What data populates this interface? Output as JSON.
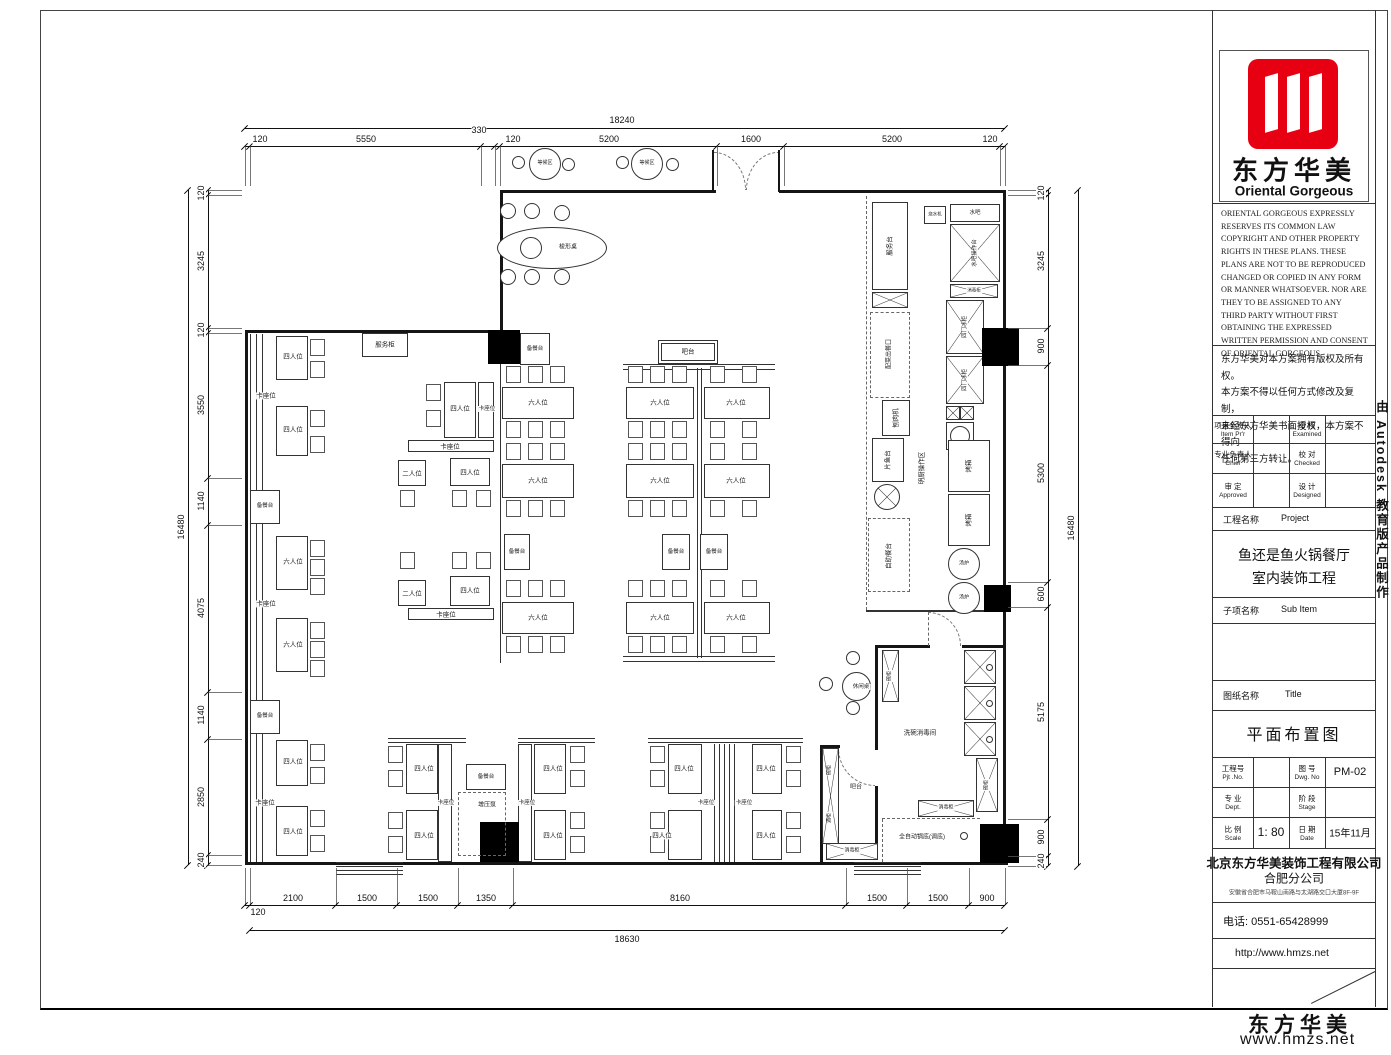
{
  "sheet": {
    "autodesk_strip": "由 Autodesk 教育版产品制作",
    "watermark_cn": "东方华美",
    "watermark_url": "www.hmzs.net"
  },
  "title_block": {
    "logo_cn": "东方华美",
    "logo_en": "Oriental Gorgeous",
    "logo_color": "#e60012",
    "copyright_en": "ORIENTAL GORGEOUS EXPRESSLY RESERVES ITS COMMON LAW COPYRIGHT AND OTHER PROPERTY RIGHTS IN THESE PLANS. THESE PLANS ARE NOT TO BE REPRODUCED CHANGED OR COPIED IN ANY FORM OR MANNER WHATSOEVER. NOR ARE THEY TO BE ASSIGNED TO ANY THIRD PARTY WITHOUT FIRST OBTAINING THE EXPRESSED WRITTEN PERMISSION AND CONSENT OF ORIENTAL GORGEOUS",
    "copyright_cn": "东方华美对本方案拥有版权及所有权。\n本方案不得以任何方式修改及复制，\n未经东方华美书面授权，本方案不得向\n任何第三方转让。",
    "fields": {
      "item_principal_cn": "项目负责人",
      "item_principal_en": "Item Pr'r",
      "examined_cn": "审 核",
      "examined_en": "Examined",
      "chief_cn": "专业负责人",
      "chief_en": "Chief",
      "checked_cn": "校 对",
      "checked_en": "Checked",
      "approved_cn": "审 定",
      "approved_en": "Approved",
      "designed_cn": "设 计",
      "designed_en": "Designed",
      "project_label_cn": "工程名称",
      "project_label_en": "Project",
      "project_name_line1": "鱼还是鱼火锅餐厅",
      "project_name_line2": "室内装饰工程",
      "subitem_label_cn": "子项名称",
      "subitem_label_en": "Sub Item",
      "title_label_cn": "图纸名称",
      "title_label_en": "Title",
      "drawing_title": "平面布置图",
      "pjt_no_cn": "工程号",
      "pjt_no_en": "Pjt .No.",
      "dwg_no_cn": "图 号",
      "dwg_no_en": "Dwg. No",
      "dwg_no_value": "PM-02",
      "dept_cn": "专 业",
      "dept_en": "Dept.",
      "stage_cn": "阶 段",
      "stage_en": "Stage",
      "scale_cn": "比 例",
      "scale_en": "Scale",
      "scale_value": "1: 80",
      "date_cn": "日 期",
      "date_en": "Date",
      "date_value": "15年11月",
      "company_line1": "北京东方华美装饰工程有限公司",
      "company_line2": "合肥分公司",
      "company_address": "安徽省合肥市马鞍山南路与太湖路交口大厦8F-9F",
      "phone": "电话: 0551-65428999",
      "website": "http://www.hmzs.net"
    }
  },
  "plan": {
    "dims": [
      {
        "o": "h",
        "y": 128,
        "a": 245,
        "b": 1005,
        "off": -8,
        "ticks": [
          245,
          1005
        ],
        "labels": [
          {
            "t": "18240",
            "p": 622
          }
        ]
      },
      {
        "o": "h",
        "y": 146,
        "a": 245,
        "b": 1005,
        "off": -7,
        "ext": 40,
        "ticks": [
          245,
          250,
          481,
          495,
          500,
          717,
          784,
          1000,
          1005
        ],
        "labels": [
          {
            "t": "120",
            "p": 260
          },
          {
            "t": "5550",
            "p": 366
          },
          {
            "t": "330",
            "p": 479,
            "dy": -9
          },
          {
            "t": "120",
            "p": 513
          },
          {
            "t": "5200",
            "p": 609
          },
          {
            "t": "1600",
            "p": 751
          },
          {
            "t": "5200",
            "p": 892
          },
          {
            "t": "120",
            "p": 990
          }
        ]
      },
      {
        "o": "h",
        "y": 905,
        "a": 245,
        "b": 1005,
        "off": -7,
        "ext": -37,
        "ticks": [
          245,
          250,
          336,
          397,
          458,
          513,
          846,
          907,
          969,
          1005
        ],
        "labels": [
          {
            "t": "120",
            "p": 258,
            "dy": 14
          },
          {
            "t": "2100",
            "p": 293
          },
          {
            "t": "1500",
            "p": 367
          },
          {
            "t": "1500",
            "p": 428
          },
          {
            "t": "1350",
            "p": 486
          },
          {
            "t": "8160",
            "p": 680
          },
          {
            "t": "1500",
            "p": 877
          },
          {
            "t": "1500",
            "p": 938
          },
          {
            "t": "900",
            "p": 987
          }
        ]
      },
      {
        "o": "h",
        "y": 930,
        "a": 250,
        "b": 1005,
        "off": 9,
        "ticks": [
          250,
          1005
        ],
        "labels": [
          {
            "t": "18630",
            "p": 627
          }
        ]
      },
      {
        "o": "v",
        "x": 208,
        "a": 190,
        "b": 865,
        "off": -7,
        "ext": 34,
        "ticks": [
          190,
          195,
          328,
          333,
          478,
          525,
          692,
          739,
          855,
          865
        ],
        "labels": [
          {
            "t": "120",
            "p": 193
          },
          {
            "t": "3245",
            "p": 261
          },
          {
            "t": "120",
            "p": 330
          },
          {
            "t": "3550",
            "p": 405
          },
          {
            "t": "1140",
            "p": 501
          },
          {
            "t": "4075",
            "p": 608
          },
          {
            "t": "1140",
            "p": 715
          },
          {
            "t": "2850",
            "p": 797
          },
          {
            "t": "240",
            "p": 860
          }
        ]
      },
      {
        "o": "v",
        "x": 188,
        "a": 190,
        "b": 865,
        "off": -7,
        "ticks": [
          190,
          865
        ],
        "labels": [
          {
            "t": "16480",
            "p": 527
          }
        ]
      },
      {
        "o": "v",
        "x": 1048,
        "a": 190,
        "b": 866,
        "off": -7,
        "ext": -40,
        "ticks": [
          190,
          195,
          328,
          365,
          582,
          607,
          819,
          856,
          866
        ],
        "labels": [
          {
            "t": "120",
            "p": 193
          },
          {
            "t": "3245",
            "p": 261
          },
          {
            "t": "900",
            "p": 346
          },
          {
            "t": "5300",
            "p": 473
          },
          {
            "t": "600",
            "p": 594
          },
          {
            "t": "5175",
            "p": 712
          },
          {
            "t": "900",
            "p": 837
          },
          {
            "t": "240",
            "p": 861
          }
        ]
      },
      {
        "o": "v",
        "x": 1078,
        "a": 190,
        "b": 866,
        "off": -7,
        "ticks": [
          190,
          866
        ],
        "labels": [
          {
            "t": "16480",
            "p": 528
          }
        ]
      }
    ],
    "labels": [
      {
        "t": "服务柜",
        "x": 385,
        "y": 345
      },
      {
        "t": "四人位",
        "x": 293,
        "y": 357
      },
      {
        "t": "卡座位",
        "x": 266,
        "y": 396
      },
      {
        "t": "四人位",
        "x": 293,
        "y": 430
      },
      {
        "t": "备餐台",
        "x": 265,
        "y": 506,
        "fs": 5.5
      },
      {
        "t": "六人位",
        "x": 293,
        "y": 562
      },
      {
        "t": "卡座位",
        "x": 266,
        "y": 604
      },
      {
        "t": "六人位",
        "x": 293,
        "y": 645
      },
      {
        "t": "备餐台",
        "x": 265,
        "y": 716,
        "fs": 5.5
      },
      {
        "t": "四人位",
        "x": 293,
        "y": 762
      },
      {
        "t": "卡座位",
        "x": 265,
        "y": 803
      },
      {
        "t": "四人位",
        "x": 293,
        "y": 832
      },
      {
        "t": "四人位",
        "x": 460,
        "y": 409
      },
      {
        "t": "卡座位",
        "x": 487,
        "y": 409,
        "fs": 5.5
      },
      {
        "t": "卡座位",
        "x": 450,
        "y": 447
      },
      {
        "t": "二人位",
        "x": 412,
        "y": 474
      },
      {
        "t": "四人位",
        "x": 470,
        "y": 473
      },
      {
        "t": "二人位",
        "x": 412,
        "y": 594
      },
      {
        "t": "四人位",
        "x": 470,
        "y": 591
      },
      {
        "t": "卡座位",
        "x": 446,
        "y": 615
      },
      {
        "t": "备餐台",
        "x": 535,
        "y": 349,
        "fs": 5.5
      },
      {
        "t": "六人位",
        "x": 538,
        "y": 403
      },
      {
        "t": "六人位",
        "x": 538,
        "y": 481
      },
      {
        "t": "备餐台",
        "x": 517,
        "y": 552,
        "fs": 5.5
      },
      {
        "t": "六人位",
        "x": 538,
        "y": 618
      },
      {
        "t": "吧台",
        "x": 688,
        "y": 352
      },
      {
        "t": "六人位",
        "x": 660,
        "y": 403
      },
      {
        "t": "六人位",
        "x": 736,
        "y": 403
      },
      {
        "t": "六人位",
        "x": 660,
        "y": 481
      },
      {
        "t": "六人位",
        "x": 736,
        "y": 481
      },
      {
        "t": "备餐台",
        "x": 676,
        "y": 552,
        "fs": 5.5
      },
      {
        "t": "备餐台",
        "x": 714,
        "y": 552,
        "fs": 5.5
      },
      {
        "t": "六人位",
        "x": 660,
        "y": 618
      },
      {
        "t": "六人位",
        "x": 736,
        "y": 618
      },
      {
        "t": "服务台",
        "x": 890,
        "y": 246,
        "k": "r"
      },
      {
        "t": "配菜出餐口",
        "x": 890,
        "y": 354,
        "k": "r",
        "fs": 6
      },
      {
        "t": "刨肉机",
        "x": 896,
        "y": 418,
        "k": "r"
      },
      {
        "t": "片鱼台",
        "x": 888,
        "y": 460,
        "k": "r"
      },
      {
        "t": "自助餐台",
        "x": 889,
        "y": 556,
        "k": "r"
      },
      {
        "t": "明厨操作区",
        "x": 922,
        "y": 468,
        "k": "r"
      },
      {
        "t": "烧水机",
        "x": 935,
        "y": 215,
        "fs": 4.5
      },
      {
        "t": "水吧",
        "x": 975,
        "y": 213,
        "fs": 5.5
      },
      {
        "t": "水吧操作台",
        "x": 975,
        "y": 253,
        "k": "r",
        "fs": 5.5
      },
      {
        "t": "消毒柜",
        "x": 974,
        "y": 291,
        "fs": 4.5
      },
      {
        "t": "四门冰柜",
        "x": 965,
        "y": 327,
        "k": "r",
        "fs": 5.5
      },
      {
        "t": "四门冰柜",
        "x": 965,
        "y": 380,
        "k": "r",
        "fs": 5.5
      },
      {
        "t": "烤箱",
        "x": 969,
        "y": 466,
        "k": "r"
      },
      {
        "t": "烤箱",
        "x": 969,
        "y": 520,
        "k": "r"
      },
      {
        "t": "汤炉",
        "x": 964,
        "y": 564,
        "fs": 5
      },
      {
        "t": "汤炉",
        "x": 964,
        "y": 598,
        "fs": 5
      },
      {
        "t": "等候区",
        "x": 545,
        "y": 164,
        "k": "c"
      },
      {
        "t": "等候区",
        "x": 647,
        "y": 164,
        "k": "c"
      },
      {
        "t": "梭形桌",
        "x": 568,
        "y": 248,
        "fs": 6
      },
      {
        "t": "四人位",
        "x": 424,
        "y": 769
      },
      {
        "t": "卡座位",
        "x": 446,
        "y": 803,
        "fs": 5.5
      },
      {
        "t": "四人位",
        "x": 424,
        "y": 836
      },
      {
        "t": "备餐台",
        "x": 486,
        "y": 777,
        "fs": 5.5
      },
      {
        "t": "增压泵",
        "x": 487,
        "y": 806,
        "fs": 6
      },
      {
        "t": "四人位",
        "x": 553,
        "y": 769
      },
      {
        "t": "卡座位",
        "x": 527,
        "y": 803,
        "fs": 5.5
      },
      {
        "t": "四人位",
        "x": 553,
        "y": 836
      },
      {
        "t": "四人位",
        "x": 684,
        "y": 769
      },
      {
        "t": "卡座位",
        "x": 706,
        "y": 803,
        "fs": 5.5
      },
      {
        "t": "卡座位",
        "x": 744,
        "y": 803,
        "fs": 5.5
      },
      {
        "t": "四人位",
        "x": 766,
        "y": 769
      },
      {
        "t": "四人位",
        "x": 662,
        "y": 836
      },
      {
        "t": "四人位",
        "x": 766,
        "y": 836
      },
      {
        "t": "休闲桌",
        "x": 861,
        "y": 687,
        "fs": 5.5
      },
      {
        "t": "碗柜",
        "x": 890,
        "y": 676,
        "k": "r",
        "fs": 5
      },
      {
        "t": "洗碗消毒间",
        "x": 920,
        "y": 733
      },
      {
        "t": "吧台",
        "x": 856,
        "y": 788,
        "fs": 6
      },
      {
        "t": "碗柜",
        "x": 830,
        "y": 770,
        "k": "r",
        "fs": 5
      },
      {
        "t": "酒柜",
        "x": 830,
        "y": 818,
        "k": "r",
        "fs": 5
      },
      {
        "t": "消毒柜",
        "x": 946,
        "y": 808,
        "fs": 5
      },
      {
        "t": "全自动锅底(调底)",
        "x": 922,
        "y": 838,
        "fs": 6
      },
      {
        "t": "消毒柜",
        "x": 852,
        "y": 851,
        "fs": 5
      },
      {
        "t": "碗柜",
        "x": 987,
        "y": 785,
        "k": "r",
        "fs": 5
      }
    ]
  }
}
